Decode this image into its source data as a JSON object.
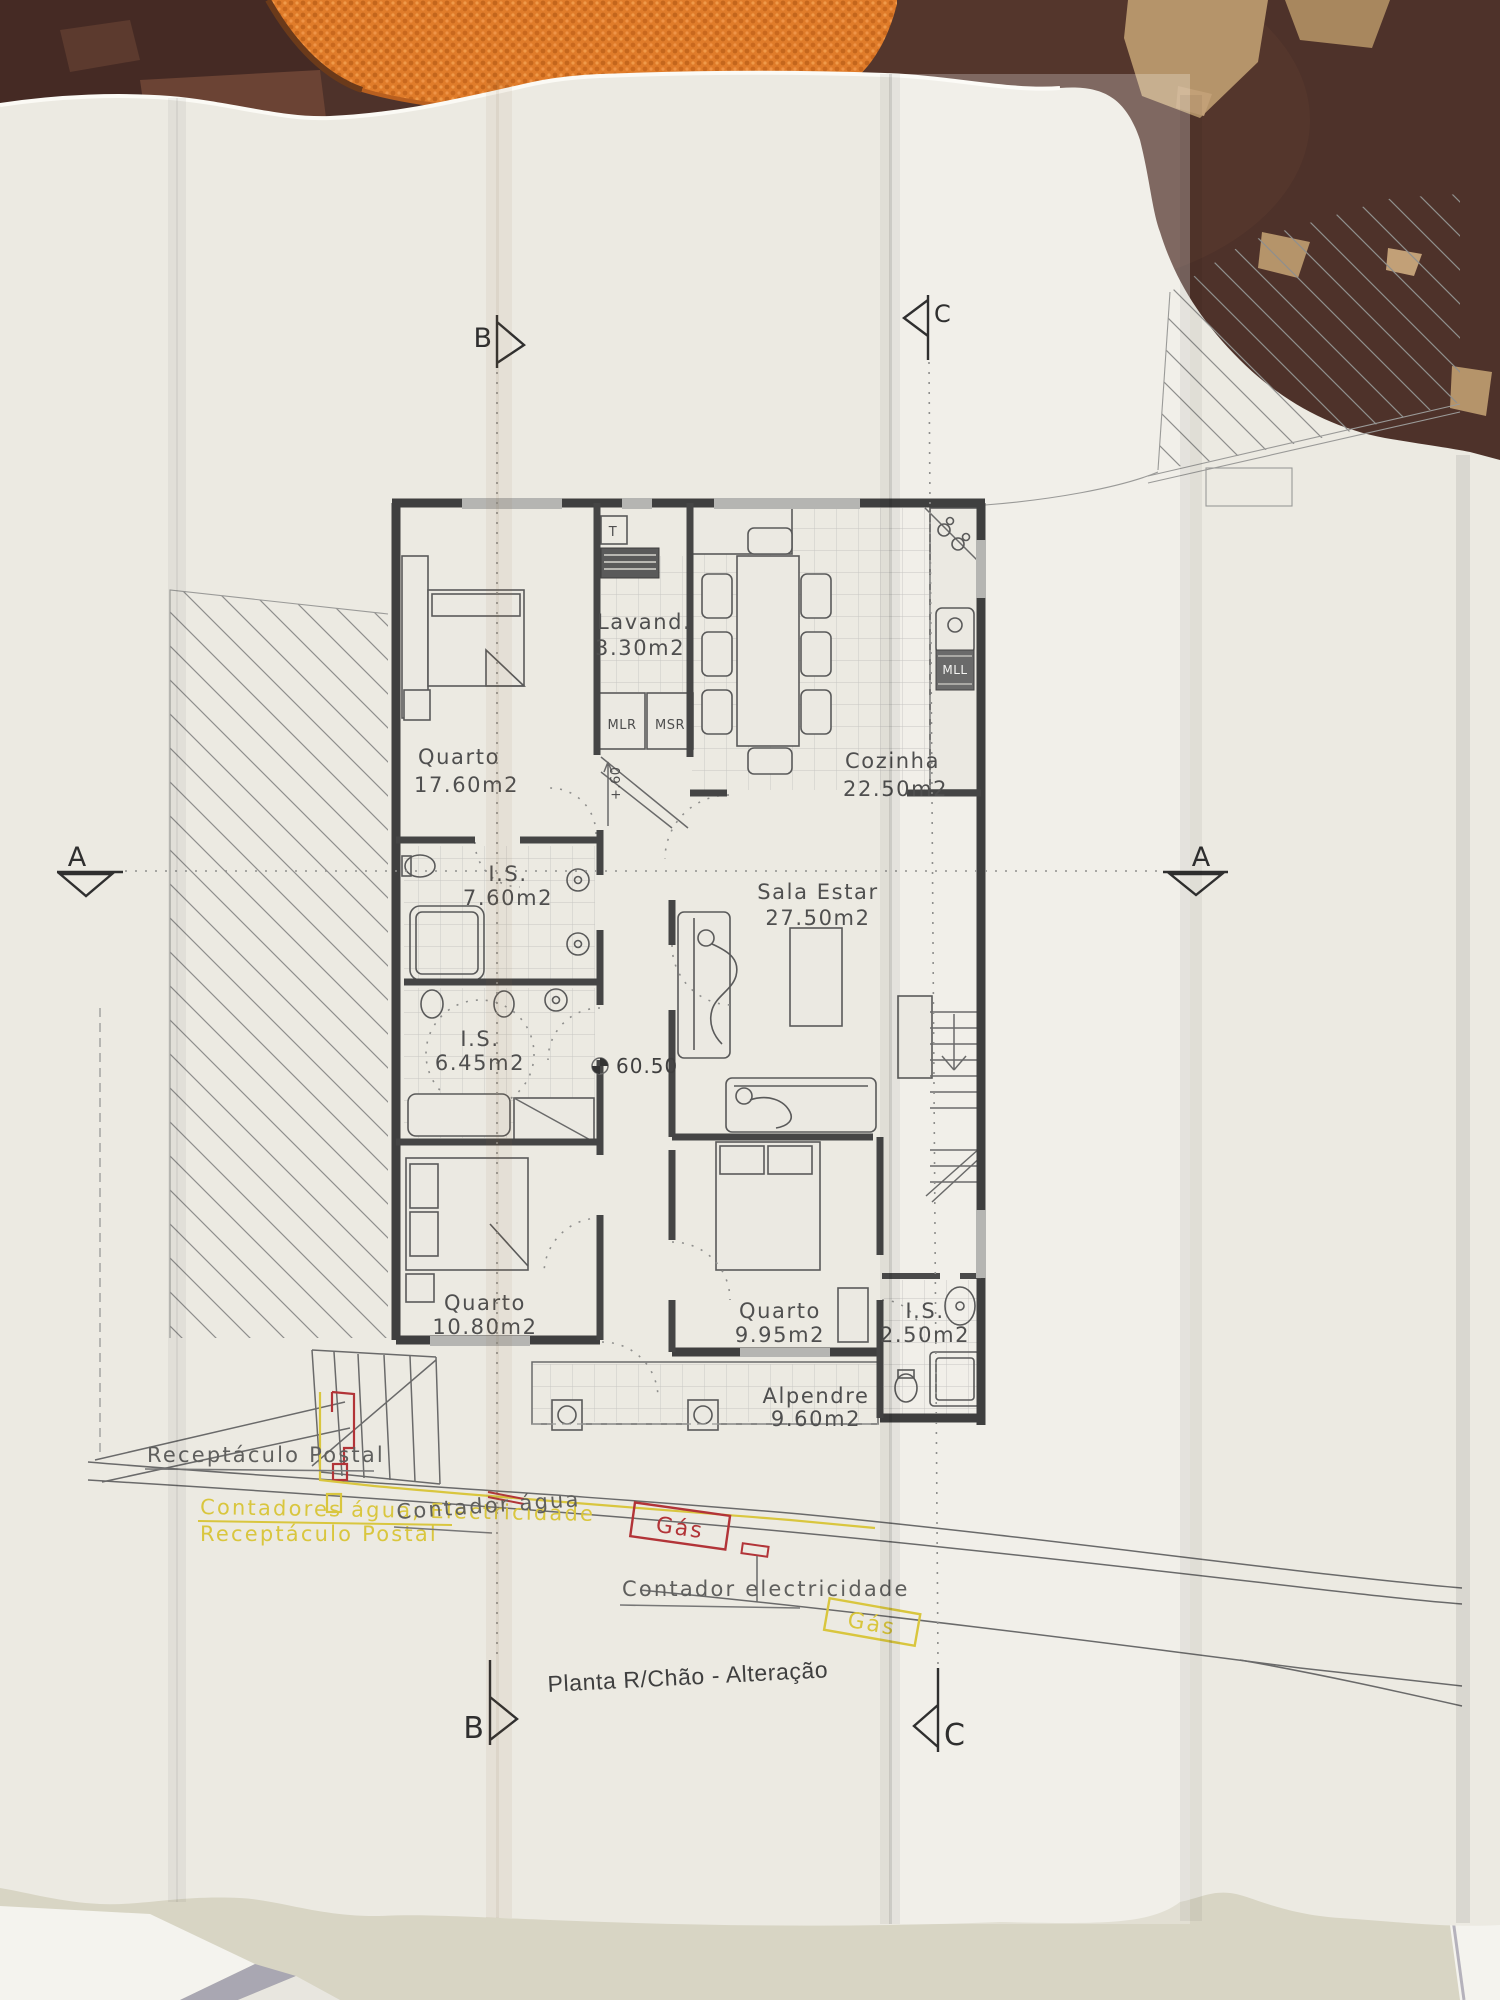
{
  "photo": {
    "background_color": "#4e322a",
    "towel_color": "#e07c2a",
    "paper_color": "#eceae2",
    "table_color": "#d8d5c4"
  },
  "plan": {
    "title": "Planta R/Chão - Alteração",
    "rooms": [
      {
        "name": "Lavand.",
        "area": "3.30m2"
      },
      {
        "name": "Cozinha",
        "area": "22.50m2"
      },
      {
        "name": "Quarto",
        "area": "17.60m2"
      },
      {
        "name": "I.S.",
        "area": "7.60m2"
      },
      {
        "name": "Sala  Estar",
        "area": "27.50m2"
      },
      {
        "name": "I.S.",
        "area": "6.45m2"
      },
      {
        "name": "Quarto",
        "area": "10.80m2"
      },
      {
        "name": "Quarto",
        "area": "9.95m2"
      },
      {
        "name": "I.S.",
        "area": "2.50m2"
      },
      {
        "name": "Alpendre",
        "area": "9.60m2"
      }
    ],
    "fixtures": {
      "t": "T",
      "mlr": "MLR",
      "msr": "MSR",
      "mll": "MLL"
    },
    "levels": {
      "floor": "60.50",
      "step": "+.60"
    },
    "sections": {
      "a": "A",
      "b": "B",
      "c": "C"
    },
    "annotations": {
      "receptaculo_postal": "Receptáculo Postal",
      "contadores": "Contadores água; Electricidade",
      "receptaculo_postal_yellow": "Receptáculo Postal",
      "contador_agua": "Contador água",
      "gas_red": "Gás",
      "contador_electricidade": "Contador electricidade",
      "gas_yellow": "Gás"
    },
    "colors": {
      "pencil": "#555555",
      "red": "#b23438",
      "yellow": "#d9c63e"
    }
  }
}
